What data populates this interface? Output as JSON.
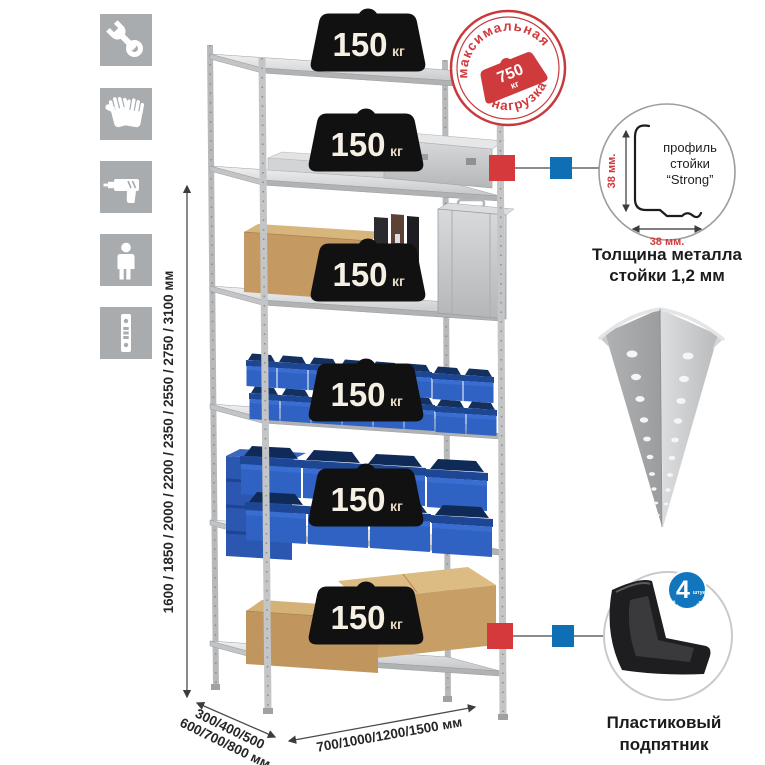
{
  "icons": [
    {
      "name": "wrench-icon"
    },
    {
      "name": "gloves-icon"
    },
    {
      "name": "drill-icon"
    },
    {
      "name": "person-icon"
    },
    {
      "name": "perforated-upright-icon"
    }
  ],
  "dims": {
    "height": "1600 / 1850 / 2000 / 2200 / 2350 / 2550 / 2750 / 3100 мм",
    "depth1": "300/400/500",
    "depth2": "600/700/800 мм",
    "width": "700/1000/1200/1500 мм"
  },
  "rack": {
    "shelf_count": 6,
    "load_value": "150",
    "load_unit": "кг"
  },
  "stamp": {
    "top": "максимальная",
    "bottom": "нагрузка",
    "value": "750",
    "unit": "кг"
  },
  "profile": {
    "l1": "профиль",
    "l2": "стойки",
    "l3": "“Strong”",
    "dv": "38 мм.",
    "dh": "38 мм.",
    "cap1": "Толщина металла",
    "cap2": "стойки 1,2 мм"
  },
  "foot": {
    "qty": "4",
    "qty_unit": "штуки",
    "arc": "в комплекте",
    "cap1": "Пластиковый",
    "cap2": "подпятник"
  },
  "colors": {
    "stamp_red": "#cf3a3c",
    "callout_red": "#d6393c",
    "callout_blue": "#0f6fb4",
    "bin_blue": "#2f62c2",
    "weight_black": "#111111",
    "icon_bg": "#a8acaf",
    "metal": "#c6c8ca"
  }
}
